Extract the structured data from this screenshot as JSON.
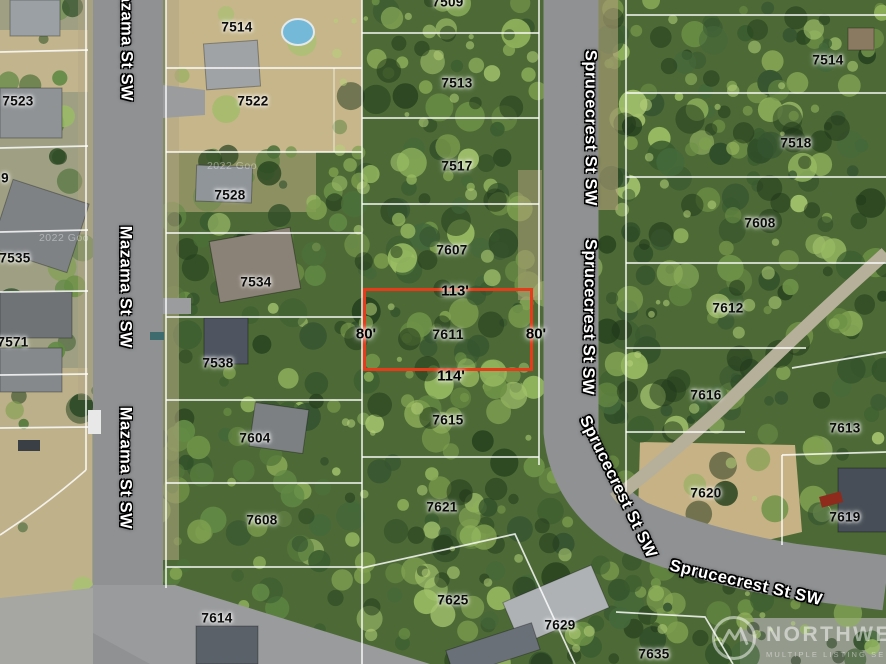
{
  "map": {
    "subject_parcel": {
      "number": "7611",
      "label_x": 448,
      "label_y": 334,
      "outline": {
        "x": 363,
        "y": 288,
        "w": 170,
        "h": 83,
        "color": "#e63b1a"
      },
      "dimensions": [
        {
          "text": "113'",
          "x": 455,
          "y": 291
        },
        {
          "text": "80'",
          "x": 366,
          "y": 334
        },
        {
          "text": "80'",
          "x": 536,
          "y": 334
        },
        {
          "text": "114'",
          "x": 451,
          "y": 376
        }
      ]
    },
    "parcel_labels": [
      {
        "text": "7509",
        "x": 448,
        "y": 2
      },
      {
        "text": "7514",
        "x": 237,
        "y": 27
      },
      {
        "text": "7514",
        "x": 828,
        "y": 60
      },
      {
        "text": "7513",
        "x": 457,
        "y": 83
      },
      {
        "text": "7523",
        "x": 18,
        "y": 101
      },
      {
        "text": "7522",
        "x": 253,
        "y": 101
      },
      {
        "text": "7518",
        "x": 796,
        "y": 143
      },
      {
        "text": "7517",
        "x": 457,
        "y": 166
      },
      {
        "text": "9",
        "x": 5,
        "y": 178
      },
      {
        "text": "7528",
        "x": 230,
        "y": 195
      },
      {
        "text": "7608",
        "x": 760,
        "y": 223
      },
      {
        "text": "7607",
        "x": 452,
        "y": 250
      },
      {
        "text": "7535",
        "x": 15,
        "y": 258
      },
      {
        "text": "7534",
        "x": 256,
        "y": 282
      },
      {
        "text": "7612",
        "x": 728,
        "y": 308
      },
      {
        "text": "7571",
        "x": 13,
        "y": 342
      },
      {
        "text": "7538",
        "x": 218,
        "y": 363
      },
      {
        "text": "7616",
        "x": 706,
        "y": 395
      },
      {
        "text": "7615",
        "x": 448,
        "y": 420
      },
      {
        "text": "7613",
        "x": 845,
        "y": 428
      },
      {
        "text": "7604",
        "x": 255,
        "y": 438
      },
      {
        "text": "7620",
        "x": 706,
        "y": 493
      },
      {
        "text": "7621",
        "x": 442,
        "y": 507
      },
      {
        "text": "7619",
        "x": 845,
        "y": 517
      },
      {
        "text": "7608",
        "x": 262,
        "y": 520
      },
      {
        "text": "7625",
        "x": 453,
        "y": 600
      },
      {
        "text": "7614",
        "x": 217,
        "y": 618
      },
      {
        "text": "7629",
        "x": 560,
        "y": 625
      },
      {
        "text": "7635",
        "x": 654,
        "y": 654
      }
    ],
    "street_labels": [
      {
        "text": "Mazama St SW",
        "x": 126,
        "y": 40,
        "rot": 90
      },
      {
        "text": "Mazama St SW",
        "x": 125,
        "y": 287,
        "rot": 90
      },
      {
        "text": "Mazama St SW",
        "x": 125,
        "y": 468,
        "rot": 90
      },
      {
        "text": "Sprucecrest St SW",
        "x": 590,
        "y": 128,
        "rot": 90
      },
      {
        "text": "Sprucecrest St SW",
        "x": 589,
        "y": 317,
        "rot": 91
      },
      {
        "text": "Sprucecrest St SW",
        "x": 618,
        "y": 487,
        "rot": 64
      },
      {
        "text": "Sprucecrest St SW",
        "x": 746,
        "y": 583,
        "rot": 13
      }
    ],
    "imagery_credits": [
      {
        "text": "2022 Goo",
        "x": 64,
        "y": 238
      },
      {
        "text": "2022 Goo",
        "x": 232,
        "y": 166
      }
    ]
  },
  "watermark": {
    "name": "NORTHWEST",
    "subtitle": "MULTIPLE LISTING SERVICE"
  }
}
